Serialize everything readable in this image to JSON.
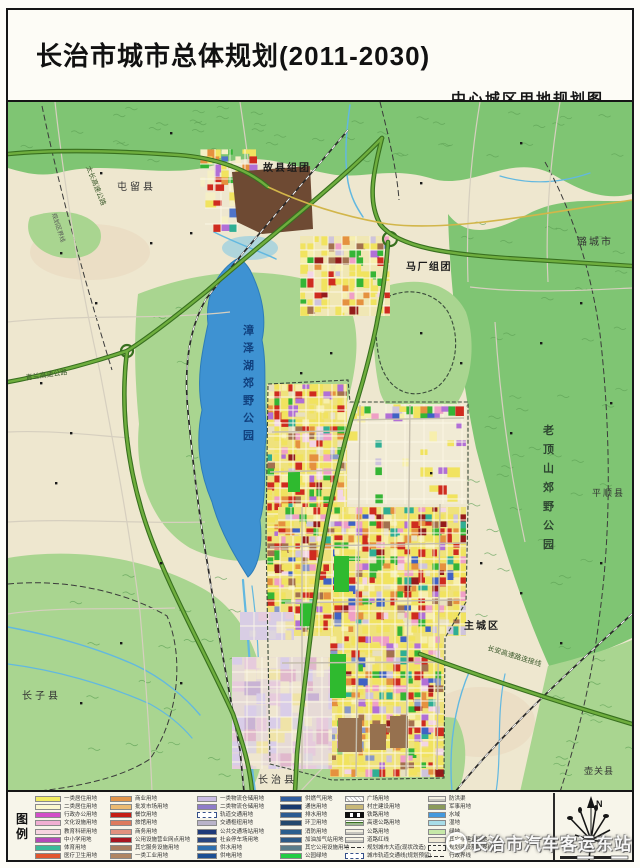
{
  "page": {
    "title": "长治市城市总体规划(2011-2030)",
    "subtitle": "中心城区用地规划图"
  },
  "watermark": {
    "text": "长治市汽车客运东站"
  },
  "compass": {
    "label": "N"
  },
  "legend": {
    "title": "图例",
    "columns": [
      [
        {
          "c": "#f2ec62",
          "t": "一类居住用地"
        },
        {
          "c": "#fbf7cf",
          "t": "二类居住用地"
        },
        {
          "c": "#d24ec8",
          "t": "行政办公用地"
        },
        {
          "c": "#f0aed2",
          "t": "文化设施用地"
        },
        {
          "c": "#f6d3e0",
          "t": "教育科研用地"
        },
        {
          "c": "#b44ab8",
          "t": "中小学用地"
        },
        {
          "c": "#3bbb9a",
          "t": "体育用地"
        },
        {
          "c": "#e2552e",
          "t": "医疗卫生用地"
        },
        {
          "c": "#ee8899",
          "t": "社会福利用地"
        }
      ],
      [
        {
          "c": "#e2954a",
          "t": "商业用地"
        },
        {
          "c": "#ecba72",
          "t": "批发市场用地"
        },
        {
          "c": "#c41d14",
          "t": "餐饮用地"
        },
        {
          "c": "#dd7a5e",
          "t": "旅馆用地"
        },
        {
          "c": "#e2907e",
          "t": "商务用地"
        },
        {
          "c": "#a81520",
          "t": "公用设施营业网点用地"
        },
        {
          "c": "#a97c5d",
          "t": "其它服务设施用地"
        },
        {
          "c": "#b08663",
          "t": "一类工业用地"
        },
        {
          "c": "#8d6a4a",
          "t": "二类工业用地"
        }
      ],
      [
        {
          "c": "#cabce4",
          "t": "一类物流仓储用地"
        },
        {
          "c": "#8f7cc9",
          "t": "二类物流仓储用地"
        },
        {
          "c": "#ffffff",
          "t": "轨道交通用地",
          "k": "dash"
        },
        {
          "c": "#b9b3c9",
          "t": "交通枢纽用地"
        },
        {
          "c": "#1e3a7a",
          "t": "公共交通场站用地"
        },
        {
          "c": "#27457f",
          "t": "社会停车场用地"
        },
        {
          "c": "#2e6fae",
          "t": "供水用地"
        },
        {
          "c": "#1c4f93",
          "t": "供电用地"
        },
        {
          "c": "#27589a",
          "t": "供热用地"
        }
      ],
      [
        {
          "c": "#2f5d9e",
          "t": "供燃气用地"
        },
        {
          "c": "#1a3a6e",
          "t": "通信用地"
        },
        {
          "c": "#2b5a91",
          "t": "排水用地"
        },
        {
          "c": "#24486e",
          "t": "环卫用地"
        },
        {
          "c": "#2b5f8e",
          "t": "消防用地"
        },
        {
          "c": "#2d5a86",
          "t": "加油加气站用地"
        },
        {
          "c": "#5a7d8a",
          "t": "其它公用设施用地"
        },
        {
          "c": "#22cc44",
          "t": "公园绿地"
        },
        {
          "c": "#9adb7a",
          "t": "防护绿地"
        }
      ],
      [
        {
          "c": "#f7f7ee",
          "t": "广场用地",
          "k": "hatch"
        },
        {
          "c": "#c8b878",
          "t": "村庄建设用地"
        },
        {
          "c": "#2a2a2a",
          "t": "铁路用地",
          "k": "rail"
        },
        {
          "c": "#6fae3e",
          "t": "高速公路用地",
          "k": "lines2"
        },
        {
          "c": "#efefe2",
          "t": "公路用地",
          "k": "line"
        },
        {
          "c": "#e8e2c8",
          "t": "道路红线",
          "k": "line"
        },
        {
          "c": "#dddddd",
          "t": "规划城市大道(现状改造)",
          "k": "dashdot"
        },
        {
          "c": "#eeeeee",
          "t": "城市轨道交通线(规划预留)",
          "k": "dash"
        },
        {
          "c": "#e8e8d8",
          "t": "远景道路",
          "k": "line"
        }
      ],
      [
        {
          "c": "#f2f2e4",
          "t": "防洪渠",
          "k": "line"
        },
        {
          "c": "#8a9a5a",
          "t": "军事用地"
        },
        {
          "c": "#4499dd",
          "t": "水域"
        },
        {
          "c": "#a8dce8",
          "t": "湿地"
        },
        {
          "c": "#c6e8a8",
          "t": "绿地"
        },
        {
          "c": "#efe9d5",
          "t": "其它非建设用地"
        },
        {
          "c": "#ffffff",
          "t": "规划建设用地界线",
          "k": "dashbox"
        },
        {
          "c": "#ffffff",
          "t": "行政界线",
          "k": "dashdot"
        },
        {
          "c": "#dddddd",
          "t": "生态控制线",
          "k": "line"
        }
      ]
    ]
  },
  "map": {
    "colors": {
      "paper": "#eee7cf",
      "hill": "#7fc573",
      "hill_light": "#a9d590",
      "lake": "#3e92d2",
      "stream": "#62b8e0",
      "expwy": "#6fae3e",
      "expwy_casing": "#38701f",
      "road": "#d6cfbf",
      "rail": "#2a2a2a",
      "brown_site": "#6e4a33",
      "industry_brown": "#96714f",
      "park_green": "#2fba2f",
      "boundary": "#3a3a3a",
      "yellow_road": "#d2b64a"
    },
    "palettes": {
      "main": [
        [
          "#f1e35f",
          30
        ],
        [
          "#f7efad",
          8
        ],
        [
          "#cf2b1f",
          11
        ],
        [
          "#35b535",
          8
        ],
        [
          "#b16fd6",
          5
        ],
        [
          "#ef9fc6",
          5
        ],
        [
          "#e5913f",
          6
        ],
        [
          "#2fae94",
          3
        ],
        [
          "#3f62c4",
          3
        ],
        [
          "#a3714f",
          5
        ],
        [
          "#941b1b",
          3
        ],
        [
          "#cfc4dc",
          4
        ],
        [
          "#f3d5e5",
          3
        ],
        [
          "#8898c8",
          2
        ],
        [
          "#e8e0c0",
          4
        ]
      ],
      "guxian": [
        [
          "#f1e35f",
          8
        ],
        [
          "#cf2b1f",
          5
        ],
        [
          "#35b535",
          6
        ],
        [
          "#b16fd6",
          4
        ],
        [
          "#e5913f",
          4
        ],
        [
          "#f5efc5",
          5
        ],
        [
          "#2fae94",
          2
        ],
        [
          "#4f74c8",
          2
        ]
      ],
      "suburb": [
        [
          "#e6cbdc",
          8
        ],
        [
          "#d9cde8",
          7
        ],
        [
          "#ddd5de",
          7
        ],
        [
          "#efe6cf",
          8
        ],
        [
          "#efe3a8",
          4
        ],
        [
          "#c9b3d4",
          3
        ],
        [
          "#e0b8cc",
          4
        ]
      ]
    },
    "districts": [
      {
        "x": 200,
        "y": 147,
        "w": 58,
        "h": 42,
        "cell": 7,
        "density": 0.7,
        "palette": "guxian",
        "grid": 15
      },
      {
        "x": 205,
        "y": 190,
        "w": 34,
        "h": 40,
        "cell": 8,
        "density": 0.4,
        "palette": "guxian",
        "grid": 16
      },
      {
        "x": 300,
        "y": 234,
        "w": 90,
        "h": 80,
        "cell": 7,
        "density": 0.6,
        "palette": "main",
        "grid": 14,
        "base": "#f0e7b4"
      },
      {
        "x": 267,
        "y": 382,
        "w": 80,
        "h": 152,
        "cell": 7,
        "density": 0.82,
        "palette": "main",
        "grid": 13,
        "base": "#efe27c"
      },
      {
        "x": 348,
        "y": 402,
        "w": 118,
        "h": 100,
        "cell": 9,
        "density": 0.12,
        "palette": "main",
        "grid": 19,
        "base": "#f1ebd5"
      },
      {
        "x": 350,
        "y": 404,
        "w": 114,
        "h": 13,
        "cell": 7,
        "density": 0.7,
        "palette": "main",
        "grid": 0
      },
      {
        "x": 278,
        "y": 505,
        "w": 188,
        "h": 129,
        "cell": 7,
        "density": 0.85,
        "palette": "main",
        "grid": 13,
        "base": "#efe27c"
      },
      {
        "x": 267,
        "y": 534,
        "w": 66,
        "h": 100,
        "cell": 7,
        "density": 0.8,
        "palette": "main",
        "grid": 13,
        "base": "#efe27c"
      },
      {
        "x": 330,
        "y": 634,
        "w": 114,
        "h": 141,
        "cell": 7,
        "density": 0.82,
        "palette": "main",
        "grid": 13,
        "base": "#efe27c"
      },
      {
        "x": 232,
        "y": 655,
        "w": 100,
        "h": 112,
        "cell": 12,
        "density": 0.8,
        "palette": "suburb",
        "grid": 15,
        "base": "#e6dad6"
      },
      {
        "x": 240,
        "y": 610,
        "w": 54,
        "h": 28,
        "cell": 9,
        "density": 0.5,
        "palette": "suburb",
        "grid": 14,
        "base": "#d8cde4"
      }
    ],
    "labels": [
      {
        "id": "label-guxian-cluster",
        "text": "故县组团",
        "x": 263,
        "y": 169,
        "fs": 10,
        "bold": true,
        "ls": 2
      },
      {
        "id": "label-tunliu-county",
        "text": "屯留县",
        "x": 117,
        "y": 188,
        "fs": 10,
        "ls": 3,
        "fill": "#333333"
      },
      {
        "id": "label-machang-cluster",
        "text": "马厂组团",
        "x": 406,
        "y": 268,
        "fs": 10,
        "bold": true,
        "ls": 1.5
      },
      {
        "id": "label-lucheng-city",
        "text": "潞城市",
        "x": 577,
        "y": 243,
        "fs": 10,
        "ls": 2,
        "fill": "#333333"
      },
      {
        "id": "label-zhangze-lake-park",
        "text": "漳泽湖郊野公园",
        "x": 243,
        "y": 332,
        "fs": 11,
        "vertical": true,
        "dy": 17.5,
        "fill": "#10407e",
        "bold": true
      },
      {
        "id": "label-laoding-mountain-park",
        "text": "老顶山郊野公园",
        "x": 543,
        "y": 432,
        "fs": 11,
        "vertical": true,
        "dy": 19,
        "fill": "#2e4631",
        "bold": true
      },
      {
        "id": "label-pingshun-county",
        "text": "平顺县",
        "x": 592,
        "y": 494,
        "fs": 9,
        "ls": 2,
        "fill": "#333333"
      },
      {
        "id": "label-main-city",
        "text": "主城区",
        "x": 464,
        "y": 627,
        "fs": 10,
        "bold": true,
        "ls": 2
      },
      {
        "id": "label-zhangzi-county",
        "text": "长子县",
        "x": 22,
        "y": 697,
        "fs": 10,
        "ls": 3,
        "fill": "#333333"
      },
      {
        "id": "label-changzhi-county",
        "text": "长治县",
        "x": 258,
        "y": 781,
        "fs": 10,
        "ls": 3,
        "fill": "#333333"
      },
      {
        "id": "label-huguan-county",
        "text": "壶关县",
        "x": 584,
        "y": 772,
        "fs": 9,
        "ls": 1,
        "fill": "#333333"
      },
      {
        "id": "label-qinglan-expressway",
        "text": "青兰高速公路",
        "x": 26,
        "y": 378,
        "fs": 7,
        "rotate": -8,
        "fill": "#3c5a2c"
      },
      {
        "id": "label-taichang-expressway",
        "text": "太长高速公路",
        "x": 86,
        "y": 165,
        "fs": 7,
        "rotate": 68,
        "fill": "#3c5a2c"
      },
      {
        "id": "label-changan-link",
        "text": "长安高速路连接线",
        "x": 487,
        "y": 648,
        "fs": 7,
        "rotate": 17,
        "fill": "#3c5a2c"
      },
      {
        "id": "label-planning-boundary",
        "text": "规划区界线",
        "x": 52,
        "y": 212,
        "fs": 6,
        "rotate": 72,
        "fill": "#555555"
      }
    ]
  }
}
